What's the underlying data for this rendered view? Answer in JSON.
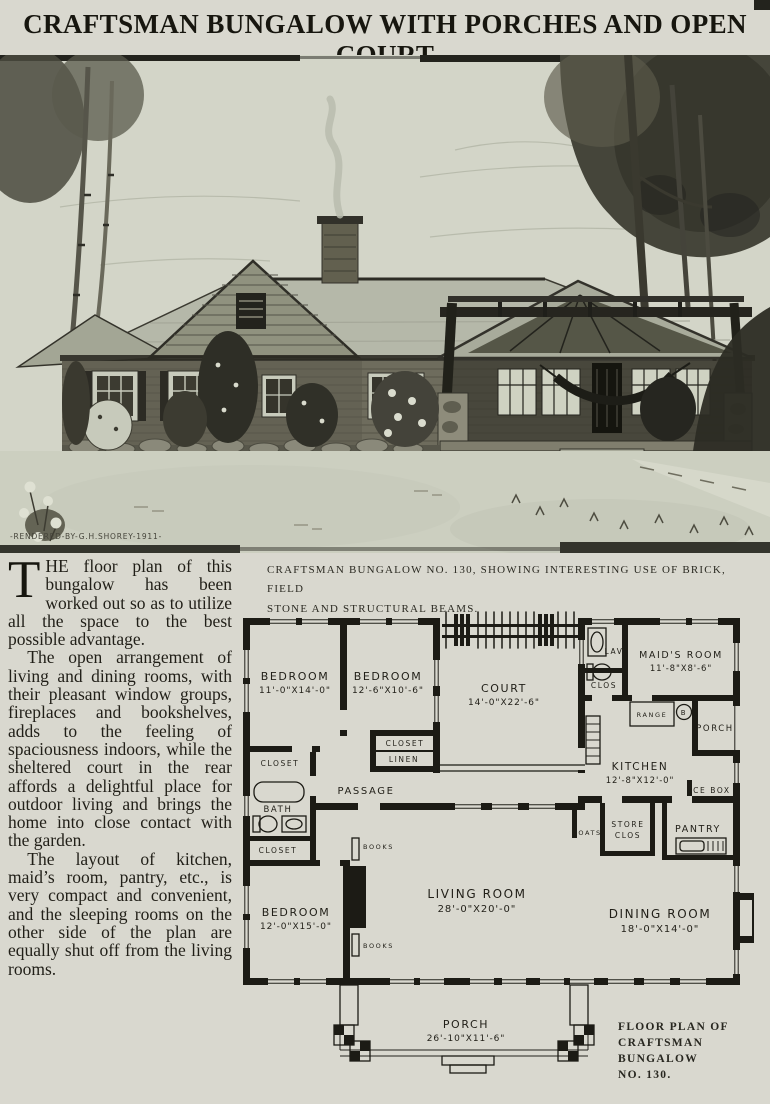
{
  "page": {
    "title": "CRAFTSMAN BUNGALOW WITH PORCHES AND OPEN COURT"
  },
  "illustration": {
    "credit": "-RENDERED-BY-G.H.SHOREY-1911-"
  },
  "caption": {
    "line1": "CRAFTSMAN BUNGALOW NO. 130, SHOWING INTERESTING USE OF BRICK, FIELD",
    "line2": "STONE AND STRUCTURAL BEAMS."
  },
  "article": {
    "drop_cap": "T",
    "p1_rest": "HE floor plan of this bungalow has been worked out so as to utilize all the space to the best possible advantage.",
    "p2": "The open arrangement of living and dining rooms, with their pleasant window groups, fireplaces and bookshelves, adds to the feeling of spaciousness indoors, while the sheltered court in the rear affords a delightful place for outdoor living and brings the home into close contact with the garden.",
    "p3": "The layout of kitchen, maid’s room, pantry, etc., is very compact and convenient, and the sleeping rooms on the other side of the plan are equally shut off from the living rooms."
  },
  "floorplan": {
    "rooms": {
      "bedroom1": {
        "name": "BEDROOM",
        "dims": "11'-0\"X14'-0\""
      },
      "bedroom2": {
        "name": "BEDROOM",
        "dims": "12'-6\"X10'-6\""
      },
      "court": {
        "name": "COURT",
        "dims": "14'-0\"X22'-6\""
      },
      "maids_room": {
        "name": "MAID'S ROOM",
        "dims": "11'-8\"X8'-6\""
      },
      "lav": {
        "name": "LAV"
      },
      "clos": {
        "name": "CLOS"
      },
      "closet_top": {
        "name": "CLOSET"
      },
      "linen": {
        "name": "LINEN"
      },
      "passage": {
        "name": "PASSAGE"
      },
      "bath": {
        "name": "BATH"
      },
      "closet_low": {
        "name": "CLOSET"
      },
      "books_top": {
        "name": "BOOKS"
      },
      "books_bottom": {
        "name": "BOOKS"
      },
      "kitchen": {
        "name": "KITCHEN",
        "dims": "12'-8\"X12'-0\""
      },
      "range": {
        "name": "RANGE"
      },
      "boiler": {
        "name": "B"
      },
      "porch_side": {
        "name": "PORCH"
      },
      "ice_box": {
        "name": "ICE BOX"
      },
      "coats": {
        "name": "COATS"
      },
      "store_closet": {
        "line1": "STORE",
        "line2": "CLOS"
      },
      "pantry": {
        "name": "PANTRY"
      },
      "living_room": {
        "name": "LIVING ROOM",
        "dims": "28'-0\"X20'-0\""
      },
      "bedroom3": {
        "name": "BEDROOM",
        "dims": "12'-0\"X15'-0\""
      },
      "dining_room": {
        "name": "DINING ROOM",
        "dims": "18'-0\"X14'-0\""
      },
      "porch_front": {
        "name": "PORCH",
        "dims": "26'-10\"X11'-6\""
      }
    },
    "caption": [
      "FLOOR PLAN OF",
      "CRAFTSMAN",
      "BUNGALOW",
      "NO. 130."
    ]
  }
}
